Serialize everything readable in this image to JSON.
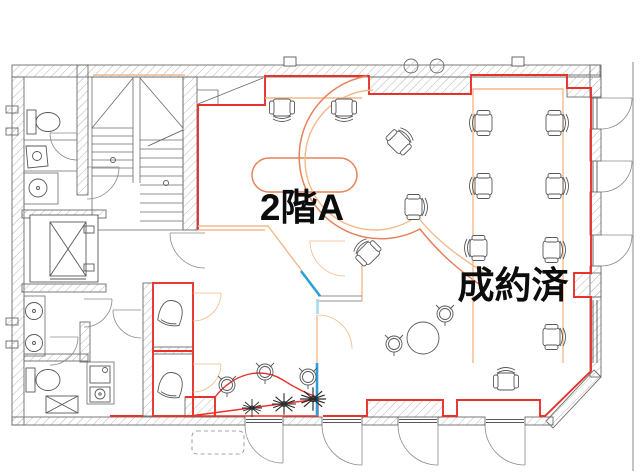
{
  "labels": {
    "area_a": "2階A",
    "sold": "成約済"
  },
  "colors": {
    "red": "#e8312a",
    "orange_red": "#e8815a",
    "light_orange": "#f4b988",
    "blue": "#2e9fdb",
    "light_blue": "#a9d9f2",
    "wall_line": "#6b6b6b",
    "furniture": "#585858",
    "label_text": "#0c0c0c",
    "hatch": "#b7b7b7"
  }
}
